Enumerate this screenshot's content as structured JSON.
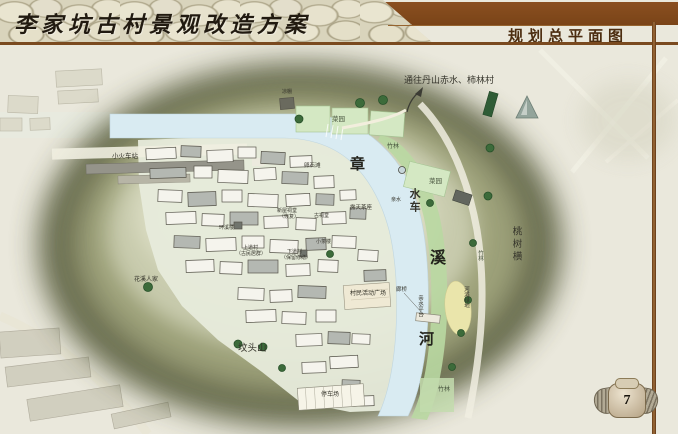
{
  "header": {
    "title": "李家坑古村景观改造方案",
    "subtitle": "规划总平面图"
  },
  "page": {
    "number": "7"
  },
  "map": {
    "route_note": "通往丹山赤水、柿林村",
    "river_name": {
      "char1": "章",
      "char2": "溪",
      "char3": "河"
    },
    "features": {
      "waterwheel": "水车",
      "veg_garden_top": "菜园",
      "veg_garden_right": "菜园",
      "pavilion": "凉棚",
      "bamboo_top": "竹林",
      "bamboo_right": "竹林",
      "bamboo_bottom": "竹林",
      "pebble_beach": "卵石滩",
      "station": "小火车站",
      "tea_terrace": "露天茶座",
      "waterfront": "亲水",
      "xinwu_hall_line1": "新屋祠堂",
      "xinwu_hall_line2": "（恢复）",
      "old_hall": "古祠堂",
      "huanxi_house": "环溪楼",
      "upper_village_line1": "上道村",
      "upper_village_line2": "（古民居群）",
      "lower_village_line1": "下道村",
      "lower_village_line2": "（保留修缮）",
      "tea_house": "小茶楼",
      "huaxi_homes": "花溪人家",
      "activity_plaza": "村民活动广场",
      "gallery_bridge": "廊桥",
      "waterfront_platform": "亲水平台",
      "riverside_green": "河滩绿地",
      "peach_grove": "桃树横",
      "tomb_hill": "坟头山",
      "parking": "停车场"
    },
    "colors": {
      "accent_brown": "#7a4a1f",
      "river_blue": "#d9ebf2",
      "hill_olive": "#5e6345",
      "bank_green": "#b9d8a2"
    }
  }
}
